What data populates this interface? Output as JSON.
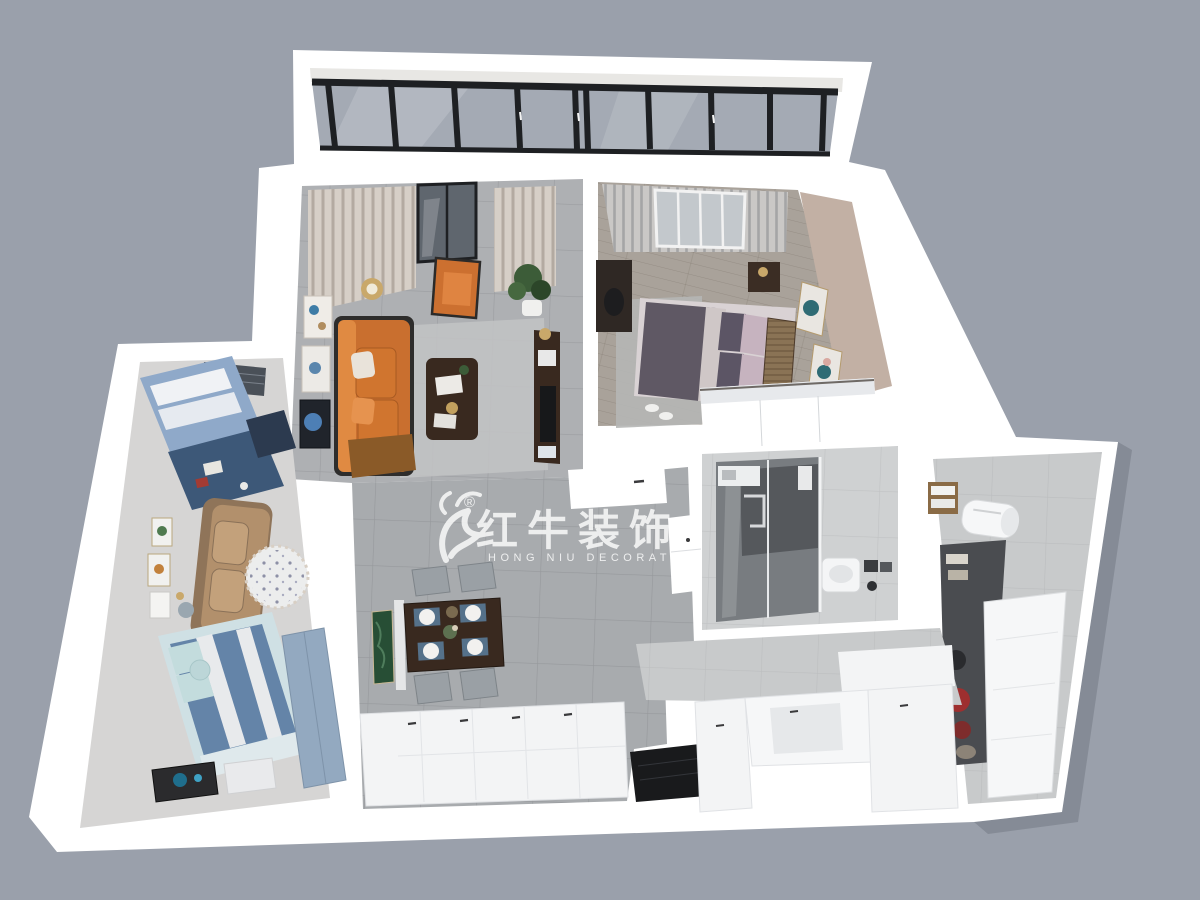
{
  "watermark": {
    "logo": "hongniu-bull-logo",
    "registered_mark": "®",
    "title": "红牛装饰",
    "subtitle": "HONG NIU DECORATION"
  },
  "palette": {
    "background": "#9aa0ab",
    "wall": "#ffffff",
    "wall_shade": "#e7e9ec",
    "tile_floor": "#aeb0b3",
    "hall_tile": "#a8abae",
    "wood_floor": "#a9a29a",
    "bedroom2_floor": "#d6d5d4",
    "accent_wall": "#c2b0a4",
    "sofa_orange": "#c96f2f",
    "armchair_orange": "#cc7030",
    "dark_wood": "#39291f",
    "rug_gray": "#c2c3c4",
    "curtain_beige": "#d6cfc7",
    "curtain_silver": "#cac8c6",
    "window_black": "#1e2023",
    "glass": "#a4aab4",
    "door_glass": "#5f666e",
    "bed_purple": "#5f5864",
    "bed_fold_pink": "#cfc7c7",
    "pillow_purple": "#5c5565",
    "pillow_pink": "#c6b3bf",
    "headboard_rattan": "#8a7355",
    "bed_blue": "#6484a8",
    "bed_frame_mint": "#cfe0e4",
    "pillow_cyan": "#c3dcdd",
    "leather_tan": "#b2906c",
    "desk_navy": "#3d5878",
    "cabinet_blue": "#8fa9c9",
    "wardrobe_blue": "#93a9c0",
    "shower_dark": "#55585c",
    "shower_glass": "#787c80",
    "marble_tile": "#c8cacb",
    "kitchen_white": "#f3f4f5",
    "entry_mat": "#191a1c",
    "chair_gray": "#9aa0a5",
    "table_mat_blue": "#55718a",
    "plant_green": "#3c5c38",
    "art_teal": "#2f6b74",
    "art_green": "#274e35",
    "gold": "#c9a86a",
    "watermark_white": "#ffffff"
  }
}
